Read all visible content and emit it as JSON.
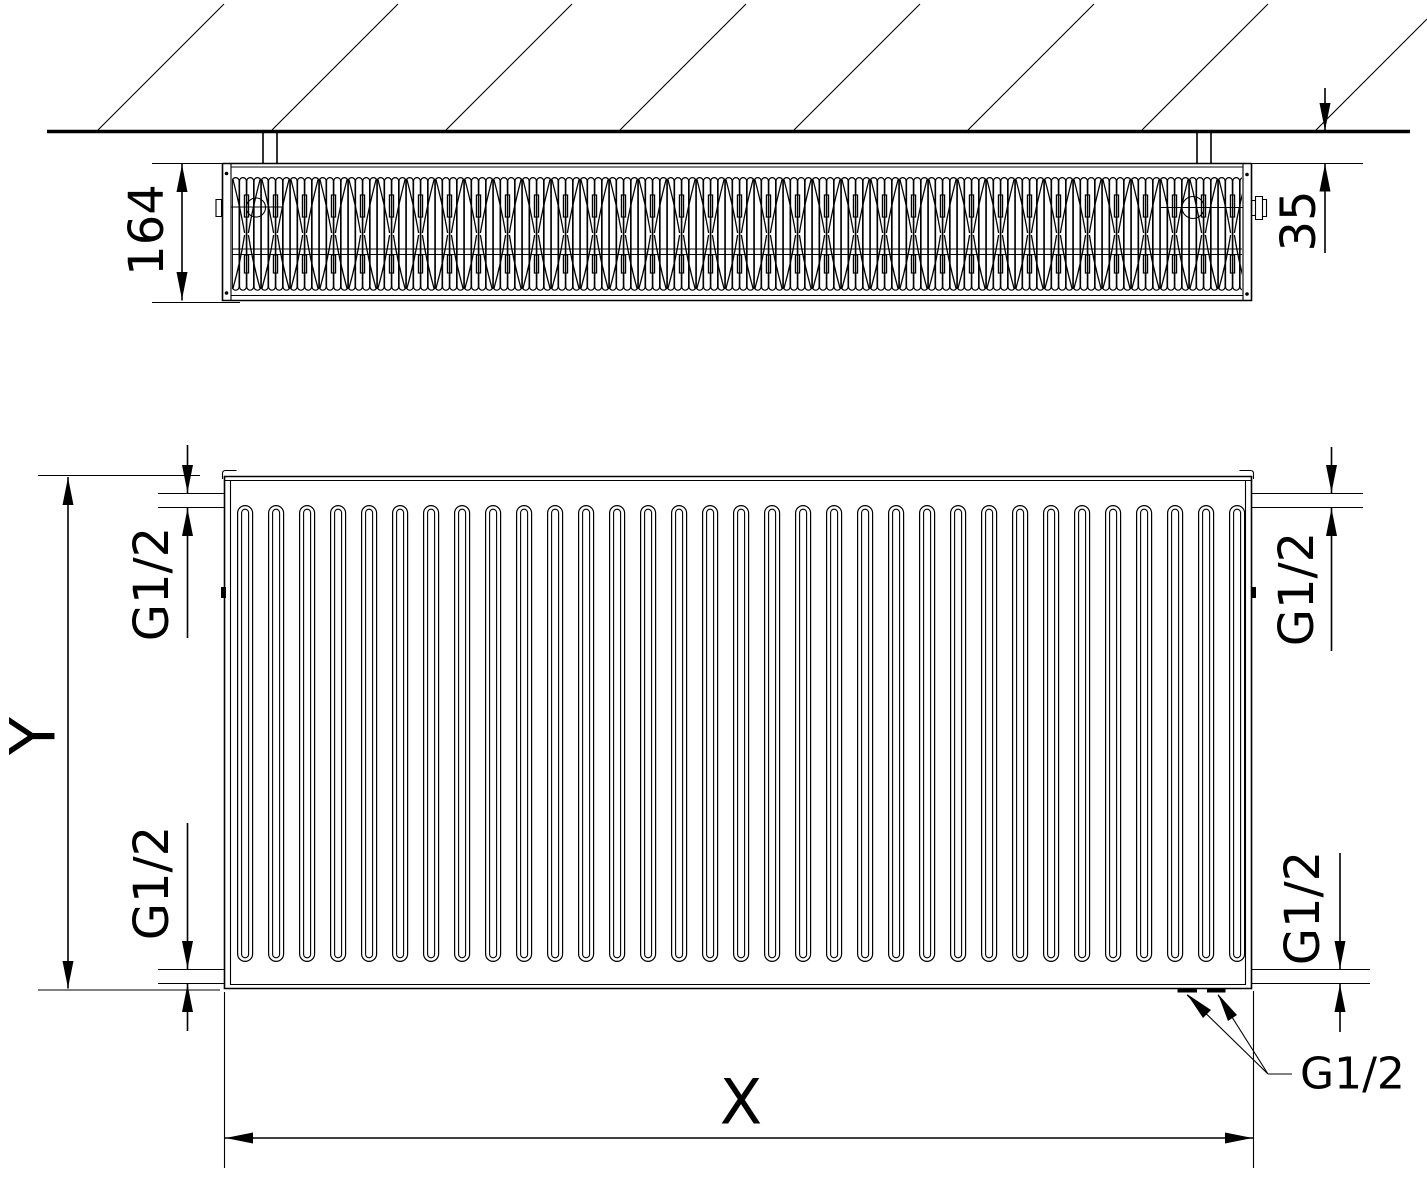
{
  "drawing": {
    "type": "radiator technical drawing, top section view and front view",
    "colors": {
      "line": "#000000",
      "background": "#ffffff"
    },
    "top_view": {
      "depth_dimension": "164",
      "wall_distance_dimension": "35"
    },
    "front_view": {
      "height_dimension": "Y",
      "width_dimension": "X",
      "connection_top_left": "G1/2",
      "connection_bottom_left": "G1/2",
      "connection_top_right": "G1/2",
      "connection_bottom_right": "G1/2",
      "connection_bottom_leader": "G1/2"
    }
  }
}
